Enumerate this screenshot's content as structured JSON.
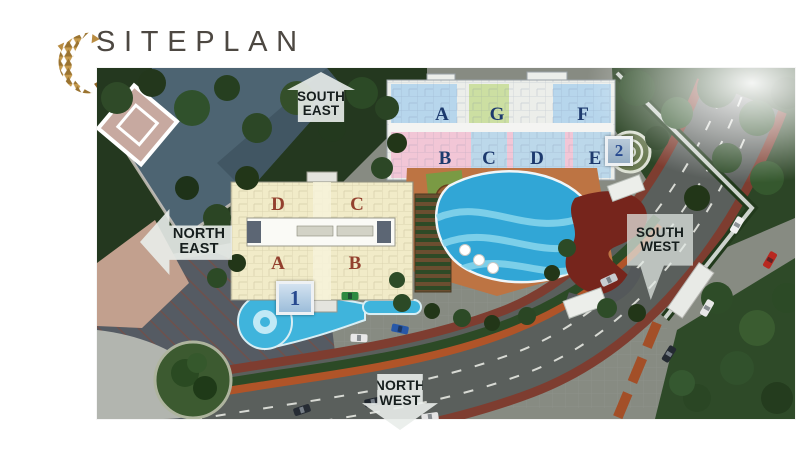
{
  "header": {
    "title": "SITEPLAN"
  },
  "logo": {
    "name": "gold-mosaic-emblem",
    "primary_color": "#b98c42",
    "shade_color": "#8f6527"
  },
  "siteplan": {
    "arrows": {
      "south_east": {
        "line1": "SOUTH",
        "line2": "EAST"
      },
      "north_east": {
        "line1": "NORTH",
        "line2": "EAST"
      },
      "south_west": {
        "line1": "SOUTH",
        "line2": "WEST"
      },
      "north_west": {
        "line1": "NORTH",
        "line2": "WEST"
      }
    },
    "tower1": {
      "badge": "1",
      "top_units": [
        "D",
        "C"
      ],
      "bottom_units": [
        "A",
        "B"
      ],
      "letter_color": "#93402e"
    },
    "tower2": {
      "badge": "2",
      "top_units": [
        "A",
        "G",
        "F"
      ],
      "bottom_units": [
        "B",
        "C",
        "D",
        "E"
      ],
      "letter_color": "#1d3a6e"
    },
    "palette": {
      "pool_blue": "#31a6d6",
      "deck_terracotta": "#bd7443",
      "plan_cream": "#f1ebc8",
      "plan_blue": "#b7d6ec",
      "plan_pink": "#f2c6d6",
      "plan_green": "#ccdfa2"
    }
  }
}
